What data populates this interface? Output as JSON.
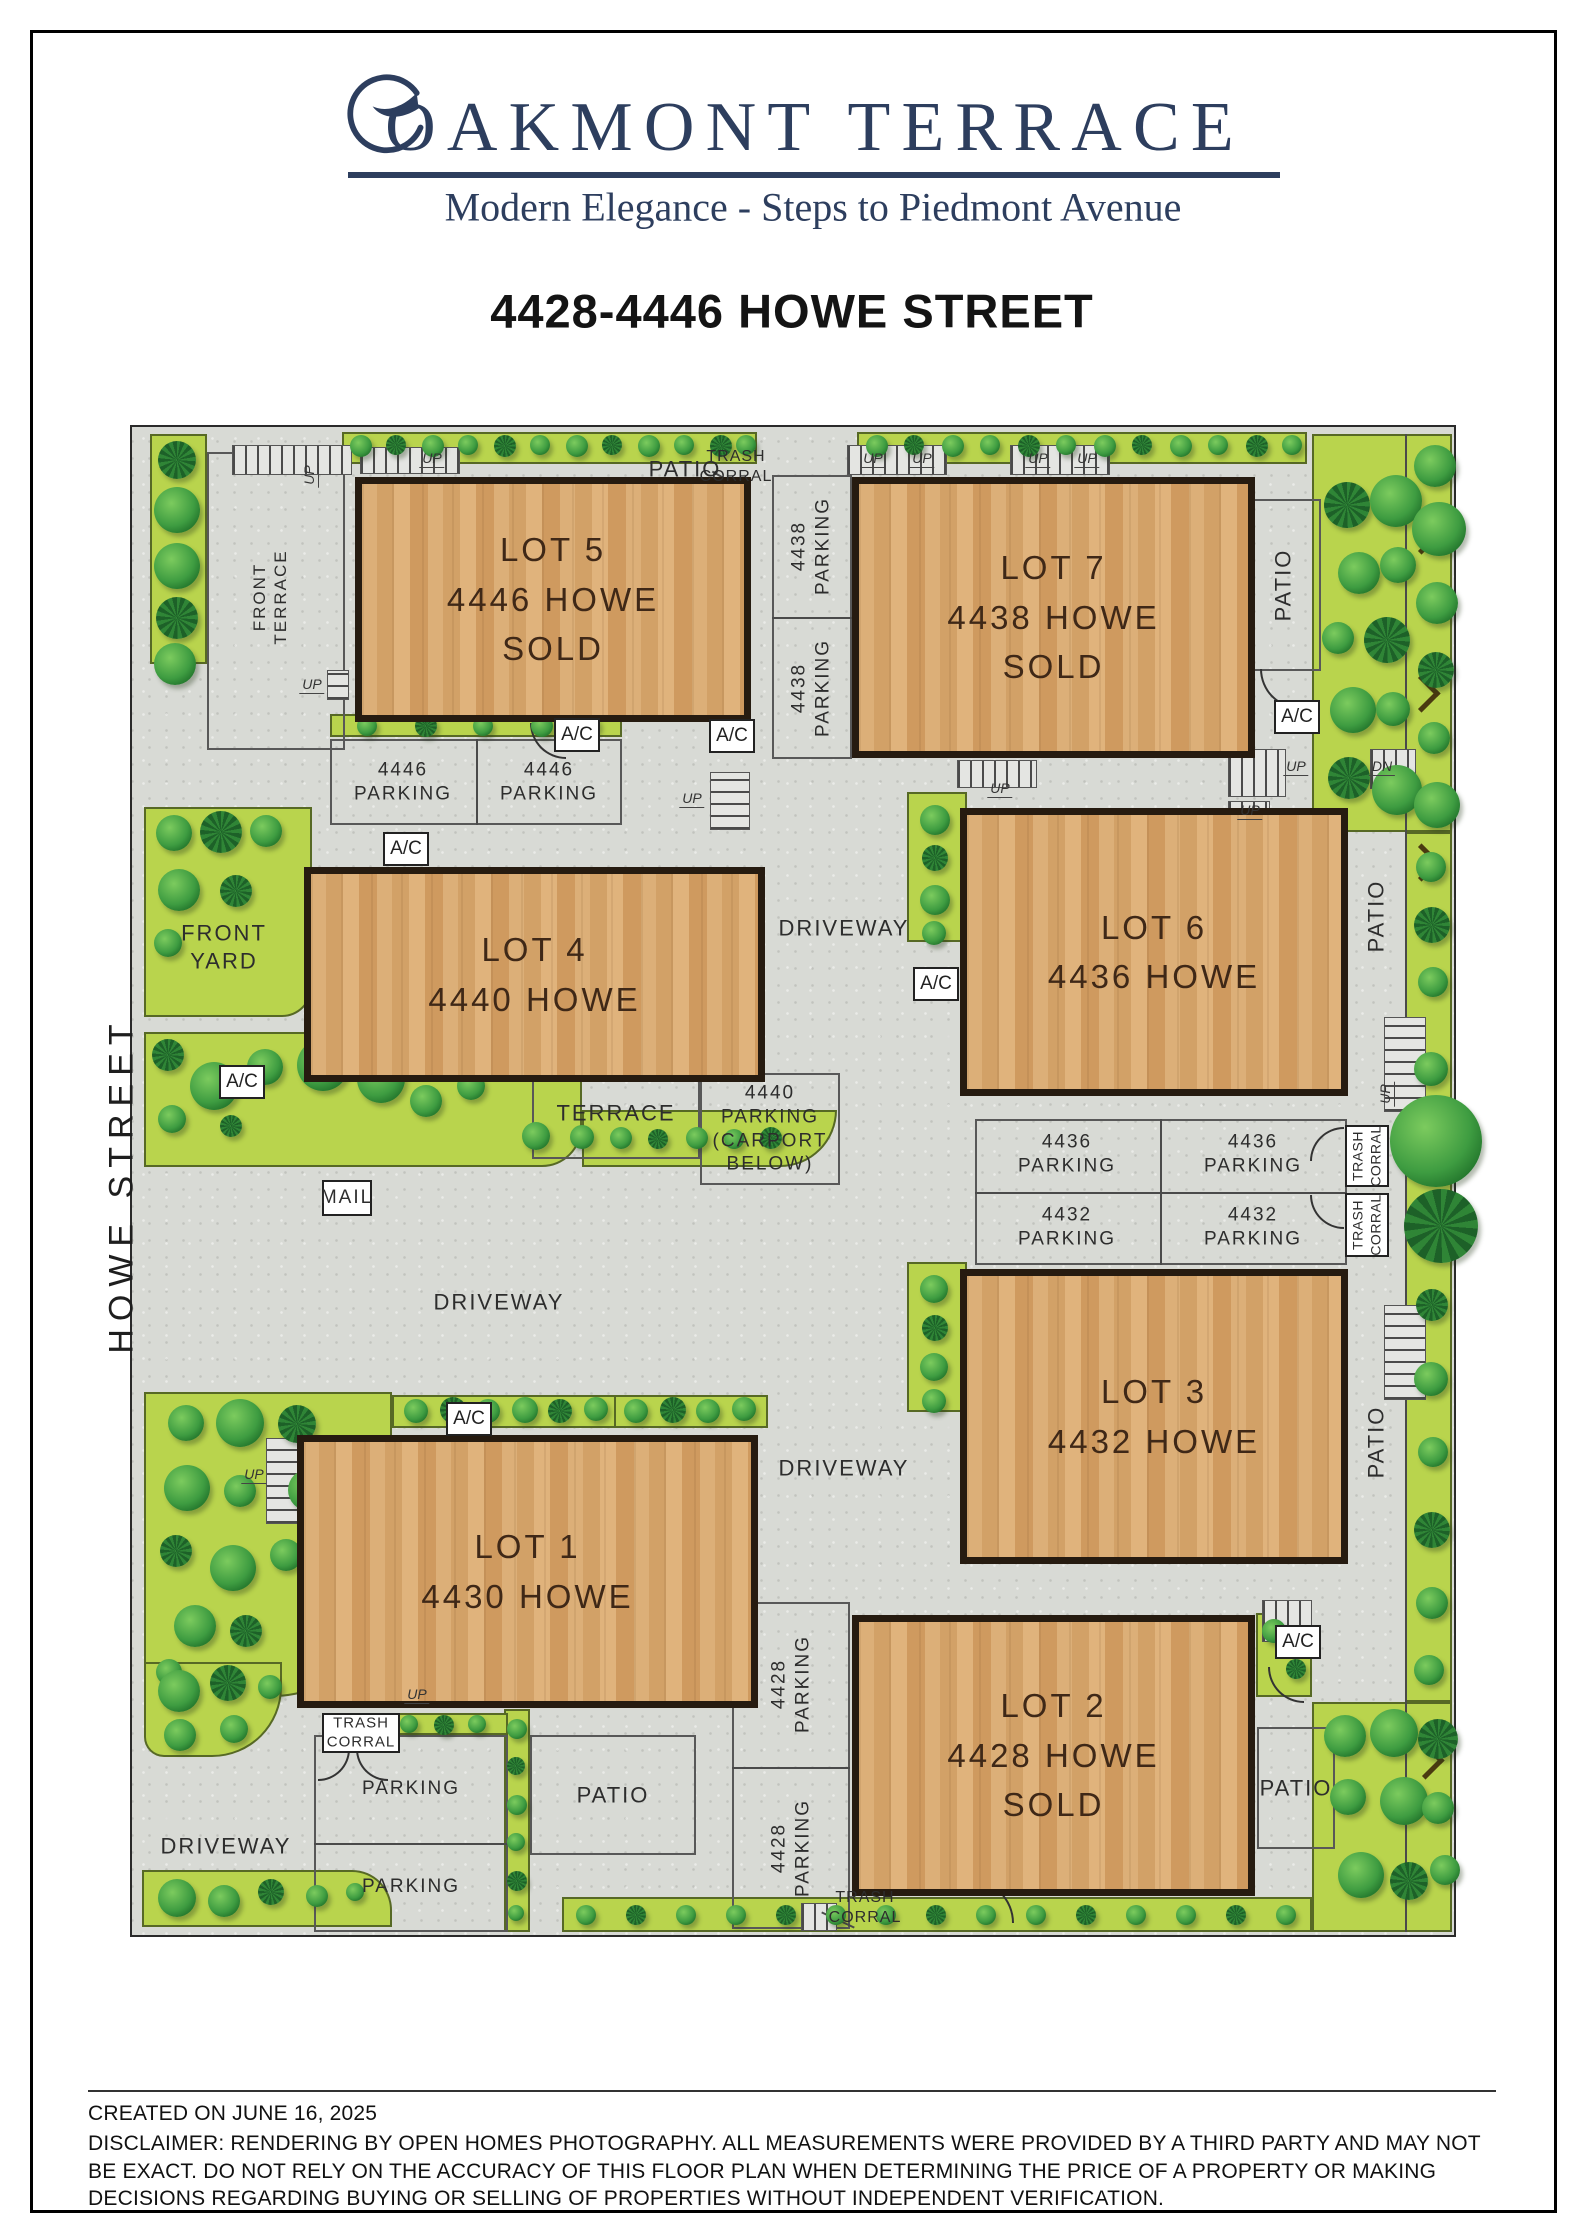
{
  "header": {
    "brand": "OAKMONT TERRACE",
    "tagline": "Modern Elegance - Steps to Piedmont Avenue",
    "title": "4428-4446 HOWE STREET"
  },
  "street": "HOWE STREET",
  "lots": {
    "lot5": {
      "name": "LOT 5",
      "addr": "4446 HOWE",
      "status": "SOLD"
    },
    "lot7": {
      "name": "LOT 7",
      "addr": "4438 HOWE",
      "status": "SOLD"
    },
    "lot4": {
      "name": "LOT 4",
      "addr": "4440 HOWE"
    },
    "lot6": {
      "name": "LOT 6",
      "addr": "4436 HOWE"
    },
    "lot3": {
      "name": "LOT 3",
      "addr": "4432 HOWE"
    },
    "lot1": {
      "name": "LOT 1",
      "addr": "4430 HOWE"
    },
    "lot2": {
      "name": "LOT 2",
      "addr": "4428 HOWE",
      "status": "SOLD"
    }
  },
  "words": {
    "patio": "PATIO",
    "trash": "TRASH",
    "corral": "CORRAL",
    "driveway": "DRIVEWAY",
    "terrace": "TERRACE",
    "front": "FRONT",
    "yard": "YARD",
    "mail": "MAIL",
    "parking": "PARKING",
    "ac": "A/C",
    "up": "UP",
    "dn": "DN",
    "n4446": "4446",
    "n4438": "4438",
    "n4436": "4436",
    "n4432": "4432",
    "n4428": "4428",
    "n4440": "4440",
    "carport": "(CARPORT",
    "below": "BELOW)"
  },
  "footer": {
    "created": "CREATED ON JUNE 16, 2025",
    "disclaimer": "DISCLAIMER: RENDERING BY OPEN HOMES PHOTOGRAPHY. ALL MEASUREMENTS WERE PROVIDED BY A THIRD PARTY AND MAY NOT BE EXACT. DO NOT RELY ON THE ACCURACY OF THIS FLOOR PLAN WHEN DETERMINING THE PRICE OF A PROPERTY OR MAKING DECISIONS REGARDING BUYING OR SELLING OF PROPERTIES WITHOUT INDEPENDENT VERIFICATION."
  },
  "colors": {
    "navy": "#2d3e5e",
    "green": "#b9d44d",
    "wood": "#d6a76c",
    "concrete": "#d8dad5"
  }
}
